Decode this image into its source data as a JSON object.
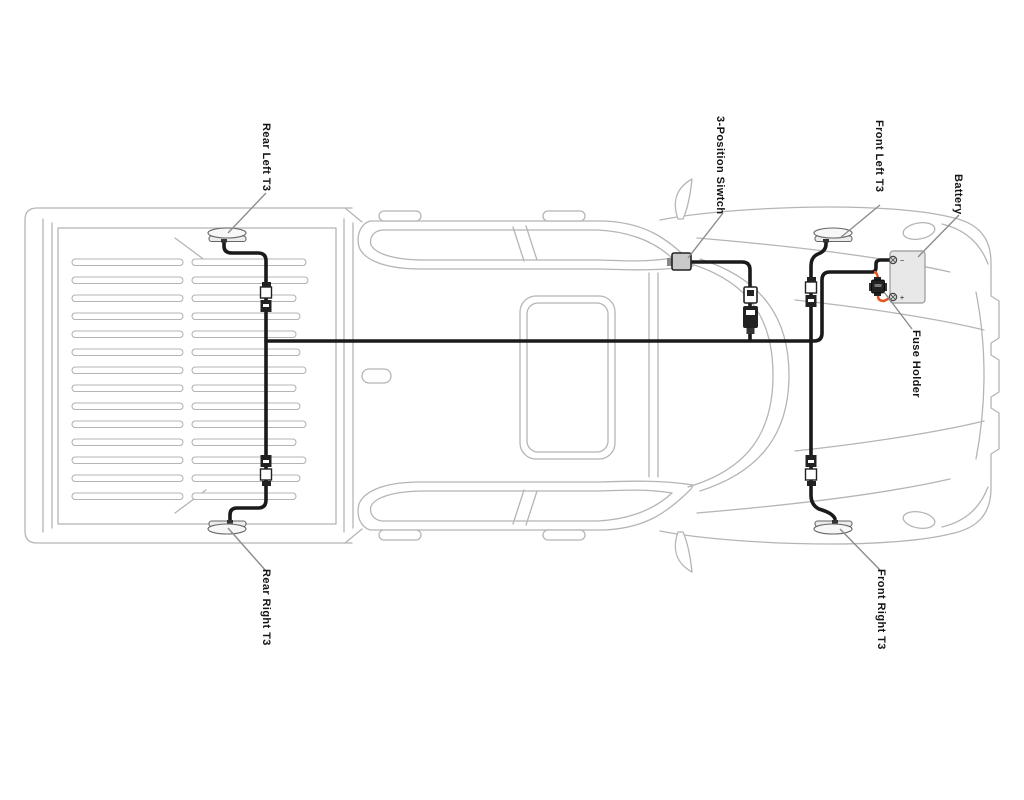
{
  "diagram": {
    "type": "vehicle-wiring-harness-top-view",
    "vehicle": "pickup-truck",
    "labels": {
      "rear_left": "Rear Left T3",
      "switch": "3-Position Siwtch",
      "front_left": "Front Left T3",
      "battery": "Battery",
      "fuse_holder": "Fuse Holder",
      "rear_right": "Rear Right T3",
      "front_right": "Front Right T3"
    },
    "battery_terminals": {
      "negative": "−",
      "positive": "+"
    },
    "colors": {
      "wire": "#1a1a1a",
      "power_wire": "#e8501e",
      "truck_outline": "#b5b5b5",
      "component_fill": "#e8e8e8",
      "label_text": "#141414",
      "leader_line": "#8c8c8c",
      "background": "#ffffff"
    }
  }
}
